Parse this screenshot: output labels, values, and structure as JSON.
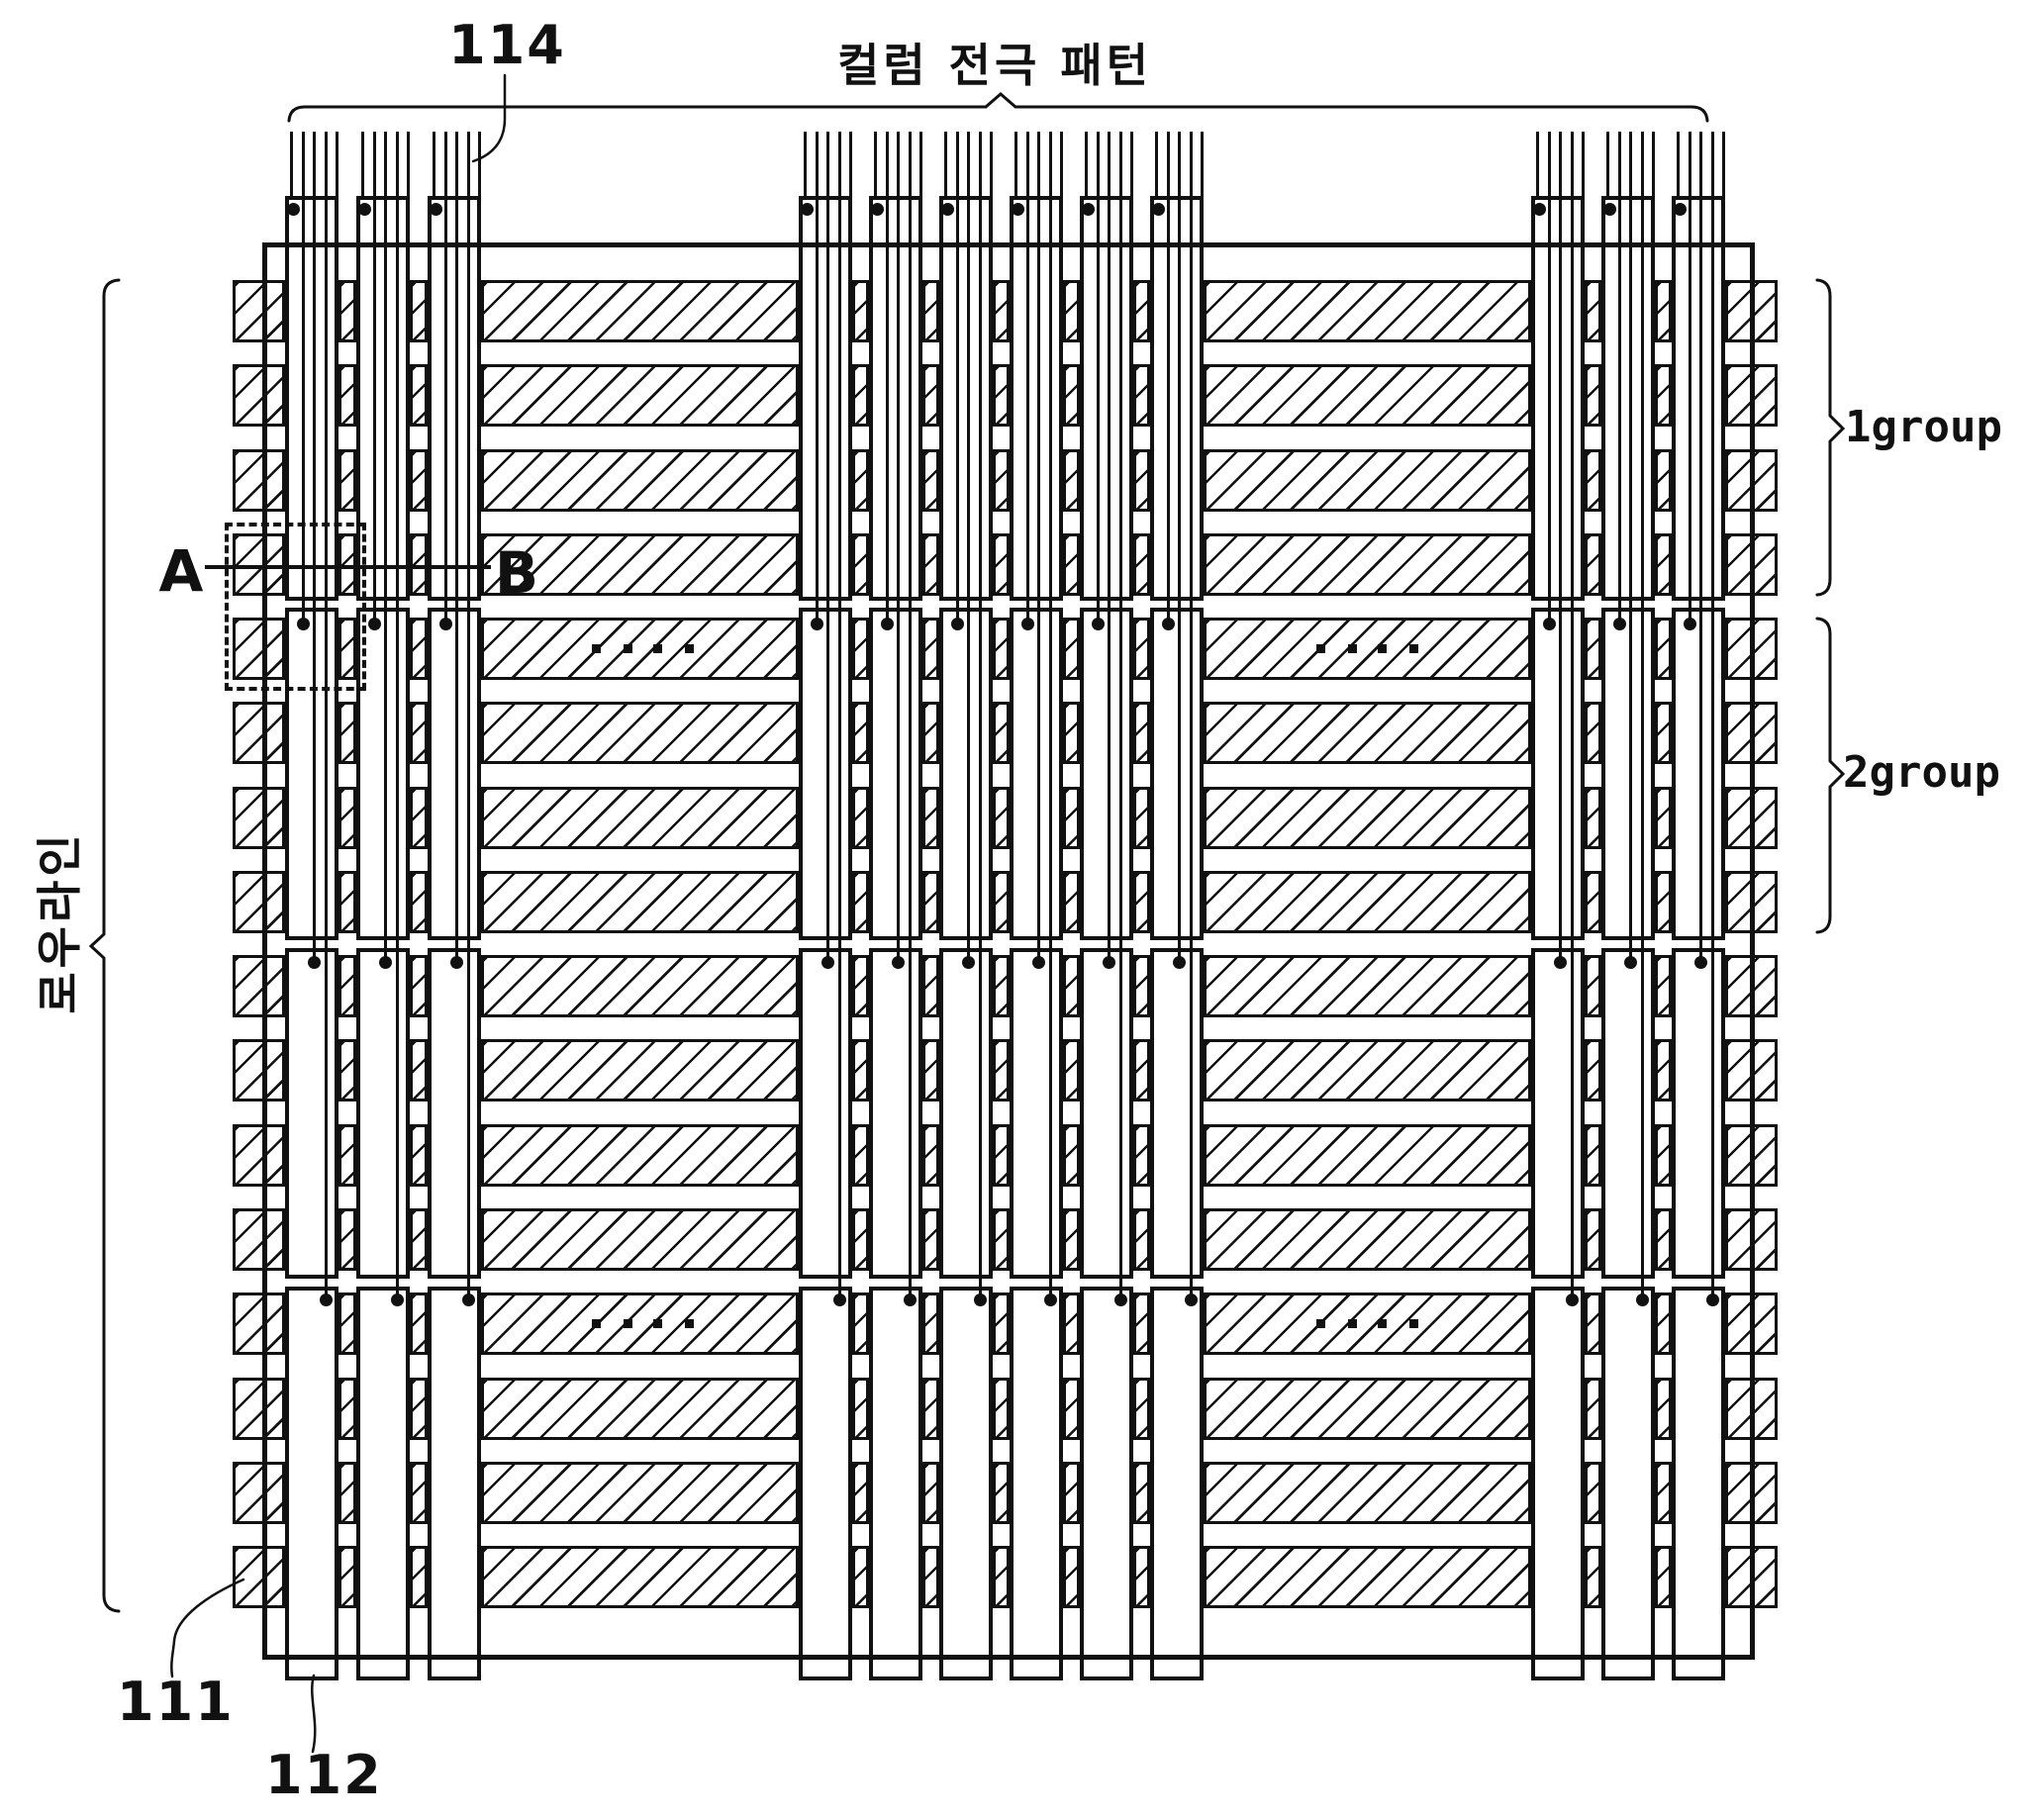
{
  "labels": {
    "ref_114": "114",
    "column_pattern": "컬럼 전극 패턴",
    "row_line": "로우라인",
    "group_1": "1group",
    "group_2": "2group",
    "section_a": "A",
    "section_b": "B",
    "ref_111": "111",
    "ref_112": "112"
  },
  "diagram": {
    "type": "patent-electrode-pattern-figure",
    "row_line_count": 16,
    "rows_per_group": 4,
    "group_count": 4,
    "column_cluster_sizes": [
      3,
      6,
      3
    ],
    "column_segments_per_electrode": 4,
    "feed_wires_above_panel_per_column": 5,
    "contact_dots_per_column": 4,
    "ellipsis_dots_per_set": 4,
    "ellipsis_sets": 4,
    "colors": {
      "ink": "#111111",
      "background": "#ffffff"
    }
  }
}
